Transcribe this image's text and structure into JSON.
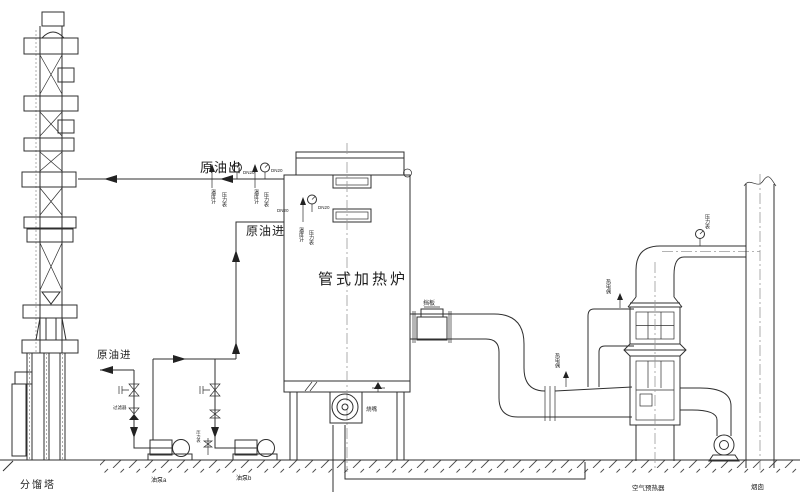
{
  "labels": {
    "tower": "分馏塔",
    "crude_out": "原油出",
    "crude_in_upper": "原油进",
    "crude_in_lower": "原油进",
    "furnace": "管式加热炉",
    "air_preheater": "空气预热器",
    "stack": "烟囱",
    "pump_a": "油泵a",
    "pump_b": "油泵b",
    "damper": "挡板",
    "burner": "烧嘴"
  },
  "annotations": {
    "dn20": "DN20",
    "temp_tap": "温度计",
    "press_tap": "压力表",
    "thermo_tap": "热电偶",
    "strainer": "过滤器"
  },
  "colors": {
    "line": "#2f2f2f",
    "centerline": "#9a9a9a",
    "background": "#ffffff"
  }
}
